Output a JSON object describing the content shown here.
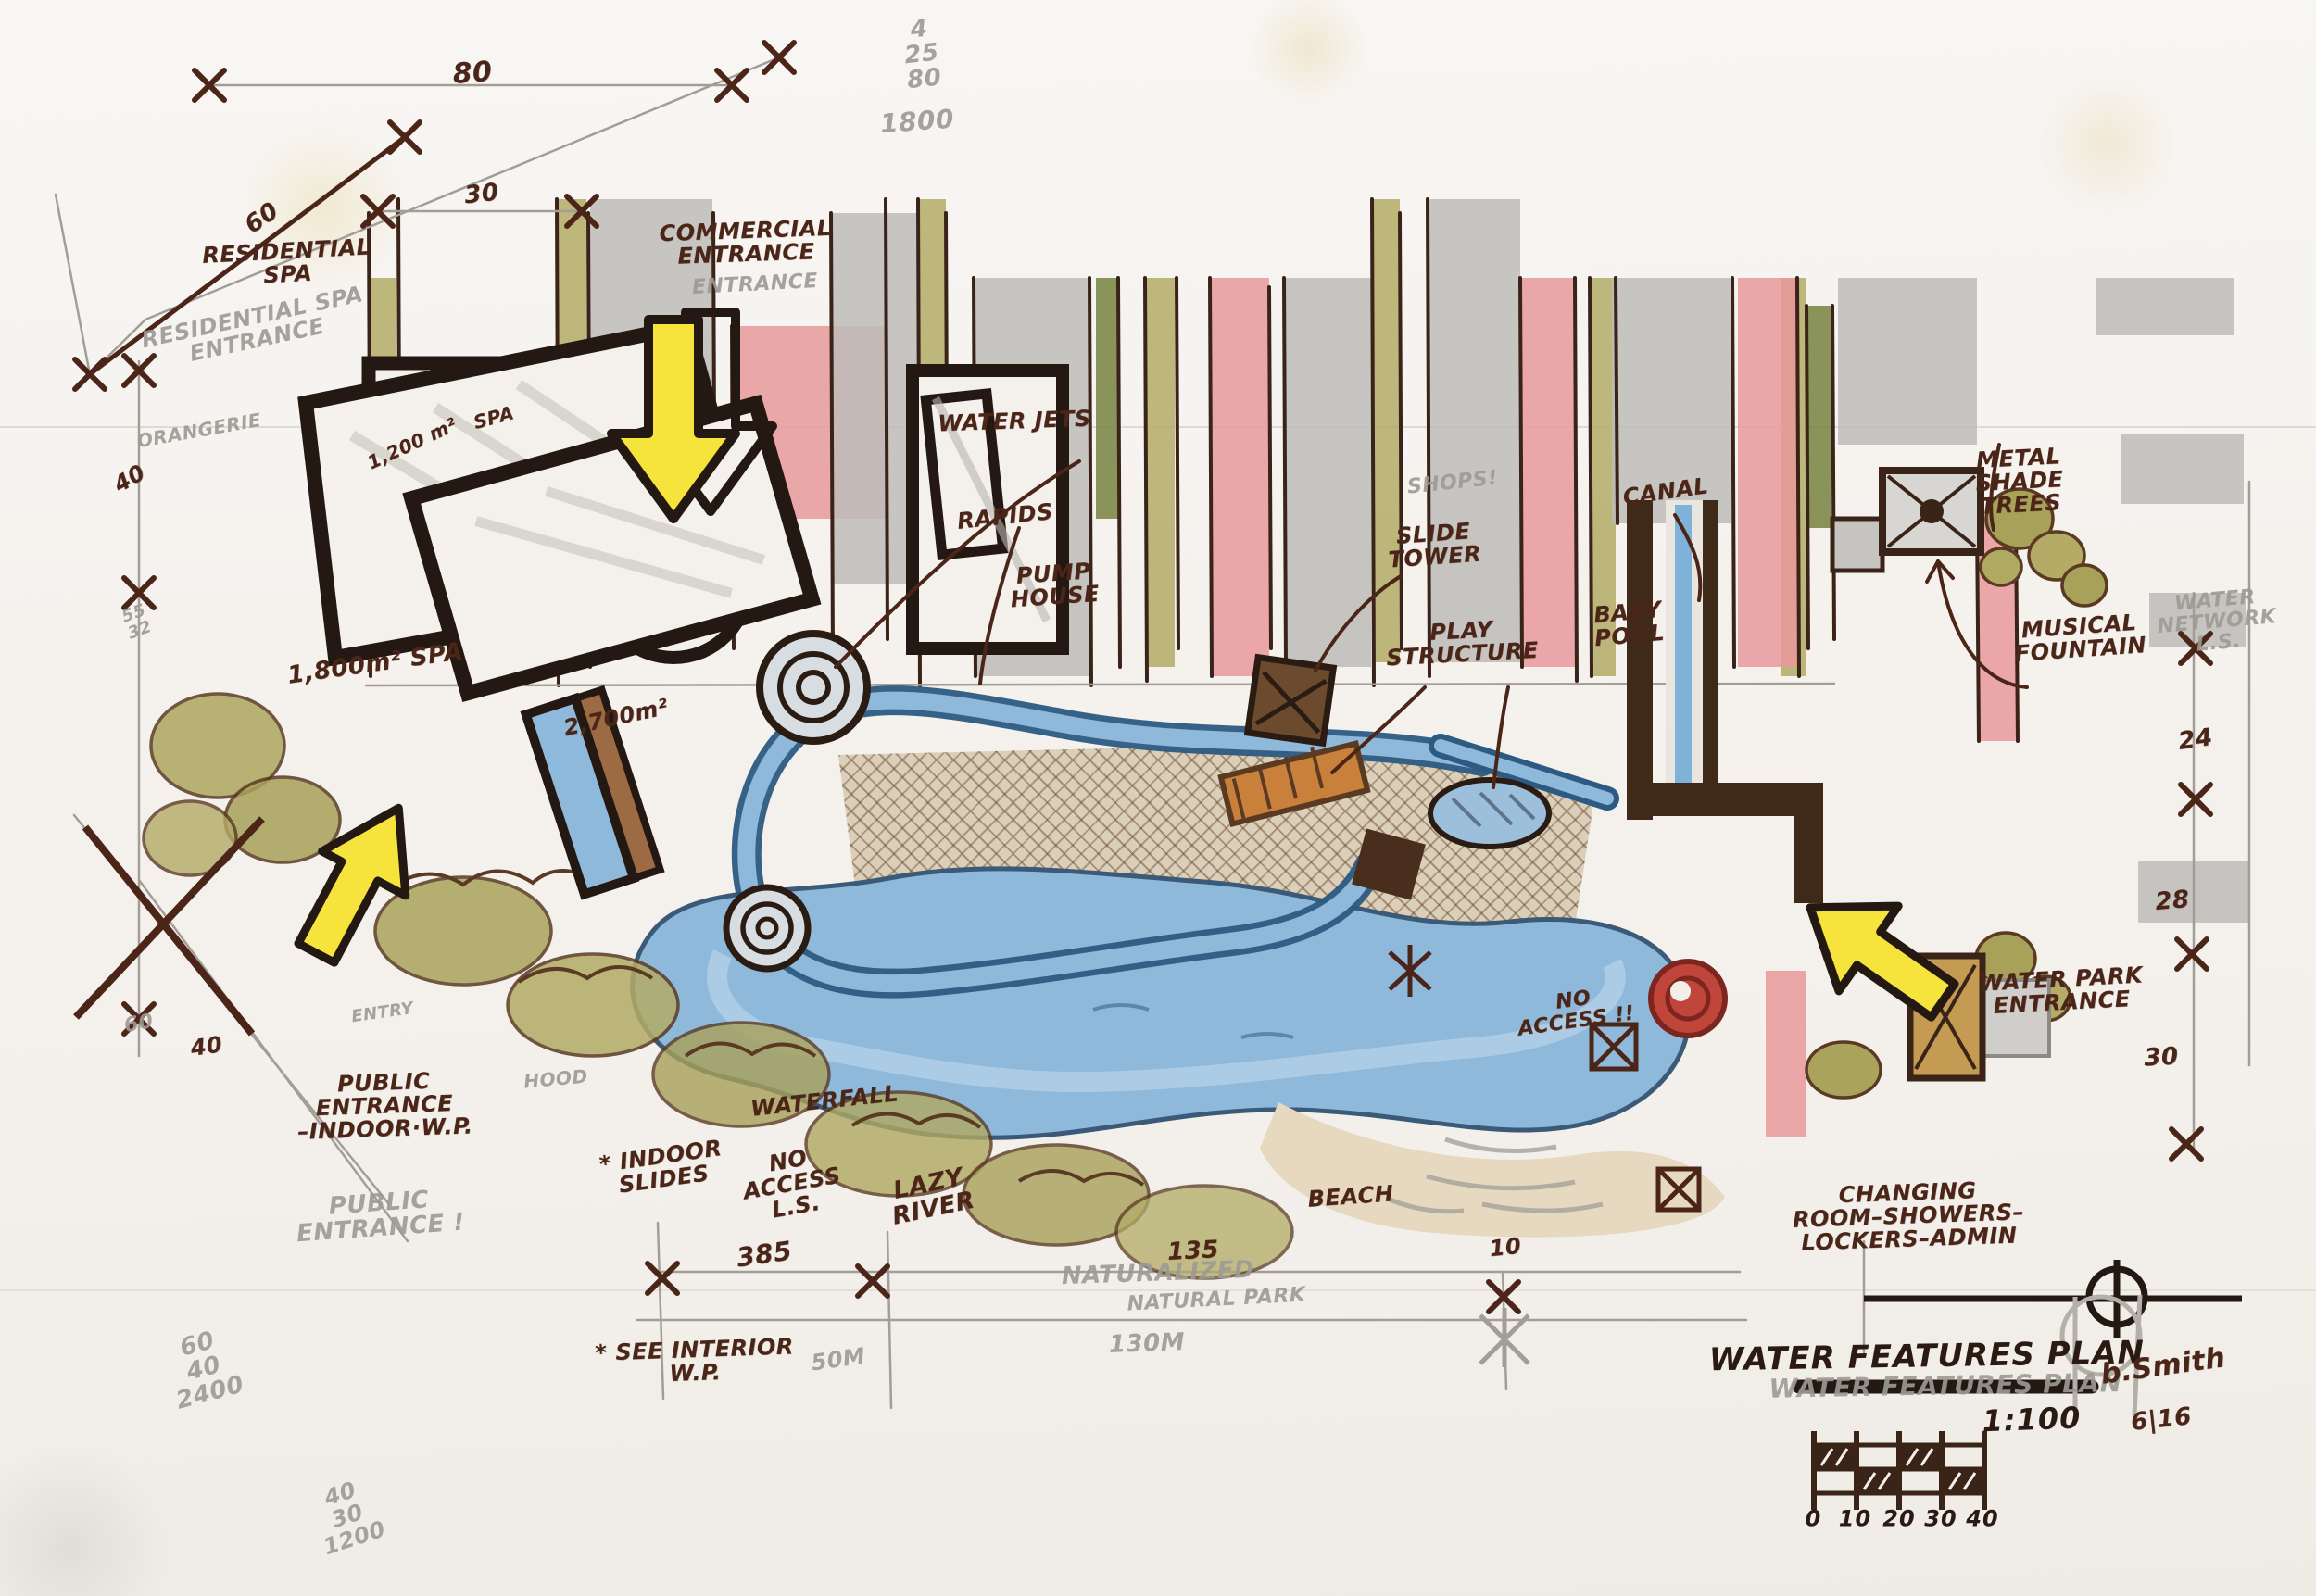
{
  "document": {
    "kind": "hand-drawn water park concept plan",
    "title": "WATER FEATURES PLAN",
    "scale": "1:100",
    "signature": "b.Smith",
    "date": "6|16",
    "scale_bar_labels": [
      "0",
      "10",
      "20",
      "30",
      "40"
    ]
  },
  "colors": {
    "paper": "#f6f3ef",
    "ink": "#4b2518",
    "pencil": "#9d9a94",
    "olive": "#b3ab66",
    "dark_green": "#77813f",
    "gray_marker": "#bdbcb9",
    "pink": "#e8999b",
    "water": "#8fb9da",
    "water_dark": "#2c5a82",
    "deck": "#dbcfb9",
    "arrow_yellow": "#f6e33c",
    "wall_dark": "#3f2a1a",
    "spiral_red": "#b03a32"
  },
  "annotations": [
    {
      "name": "dim-80",
      "style": "marker",
      "x": 20.4,
      "y": 4.6,
      "rot": -4,
      "fs": 30,
      "t": [
        "80"
      ]
    },
    {
      "name": "calc-25x80",
      "style": "pencil",
      "x": 39.8,
      "y": 3.4,
      "rot": -6,
      "fs": 26,
      "t": [
        "4",
        "25",
        "80"
      ]
    },
    {
      "name": "calc-25x80-total",
      "style": "pencil",
      "x": 39.6,
      "y": 7.6,
      "rot": -4,
      "fs": 28,
      "t": [
        "1800"
      ]
    },
    {
      "name": "dim-30-top",
      "style": "marker",
      "x": 20.8,
      "y": 12.2,
      "rot": -6,
      "fs": 26,
      "t": [
        "30"
      ]
    },
    {
      "name": "dim-60-diagonal",
      "style": "marker",
      "x": 11.3,
      "y": 13.7,
      "rot": -35,
      "fs": 26,
      "t": [
        "60"
      ]
    },
    {
      "name": "label-residential-spa",
      "style": "marker",
      "x": 12.4,
      "y": 16.5,
      "rot": -3,
      "fs": 24,
      "t": [
        "RESIDENTIAL",
        "SPA"
      ]
    },
    {
      "name": "ghost-residential-spa-entrance",
      "style": "pencil",
      "x": 11.0,
      "y": 20.6,
      "rot": -12,
      "fs": 24,
      "t": [
        "RESIDENTIAL SPA",
        "ENTRANCE"
      ]
    },
    {
      "name": "label-commercial-entrance",
      "style": "marker",
      "x": 32.2,
      "y": 15.2,
      "rot": -2,
      "fs": 24,
      "t": [
        "COMMERCIAL",
        "ENTRANCE"
      ]
    },
    {
      "name": "ghost-commercial-entrance",
      "style": "pencil",
      "x": 32.6,
      "y": 17.9,
      "rot": -3,
      "fs": 22,
      "t": [
        "ENTRANCE"
      ]
    },
    {
      "name": "ghost-orangerie",
      "style": "pencil",
      "x": 8.6,
      "y": 27.0,
      "rot": -10,
      "fs": 20,
      "t": [
        "ORANGERIE"
      ]
    },
    {
      "name": "dim-40-upper-left",
      "style": "marker",
      "x": 5.6,
      "y": 30.0,
      "rot": -30,
      "fs": 24,
      "t": [
        "40"
      ]
    },
    {
      "name": "note-55-32",
      "style": "pencil",
      "x": 5.9,
      "y": 39.0,
      "rot": -20,
      "fs": 18,
      "t": [
        "55",
        "32"
      ]
    },
    {
      "name": "label-spa-1200",
      "style": "marker",
      "x": 17.8,
      "y": 27.8,
      "rot": -25,
      "fs": 20,
      "t": [
        "1,200 m²"
      ]
    },
    {
      "name": "label-spa-upper",
      "style": "marker",
      "x": 21.3,
      "y": 26.2,
      "rot": -15,
      "fs": 20,
      "t": [
        "SPA"
      ]
    },
    {
      "name": "label-water-jets",
      "style": "marker",
      "x": 43.8,
      "y": 26.4,
      "rot": -2,
      "fs": 24,
      "t": [
        "WATER JETS"
      ]
    },
    {
      "name": "label-rapids",
      "style": "marker",
      "x": 43.4,
      "y": 32.4,
      "rot": -6,
      "fs": 24,
      "t": [
        "RAPIDS"
      ]
    },
    {
      "name": "label-pump-house",
      "style": "marker",
      "x": 45.5,
      "y": 36.7,
      "rot": -4,
      "fs": 24,
      "t": [
        "PUMP",
        "HOUSE"
      ]
    },
    {
      "name": "ghost-shops",
      "style": "pencil",
      "x": 62.7,
      "y": 30.3,
      "rot": -6,
      "fs": 22,
      "t": [
        "SHOPS!"
      ]
    },
    {
      "name": "label-slide-tower",
      "style": "marker",
      "x": 61.9,
      "y": 34.2,
      "rot": -4,
      "fs": 24,
      "t": [
        "SLIDE",
        "TOWER"
      ]
    },
    {
      "name": "label-play-structure",
      "style": "marker",
      "x": 63.1,
      "y": 40.3,
      "rot": -3,
      "fs": 24,
      "t": [
        "PLAY",
        "STRUCTURE"
      ]
    },
    {
      "name": "label-baby-pool",
      "style": "marker",
      "x": 70.3,
      "y": 39.1,
      "rot": -5,
      "fs": 24,
      "t": [
        "BABY",
        "POOL"
      ]
    },
    {
      "name": "label-canal",
      "style": "marker",
      "x": 71.9,
      "y": 30.8,
      "rot": -8,
      "fs": 24,
      "t": [
        "CANAL"
      ]
    },
    {
      "name": "label-metal-shade-trees",
      "style": "marker",
      "x": 87.2,
      "y": 30.2,
      "rot": -3,
      "fs": 24,
      "t": [
        "METAL",
        "SHADE",
        "TREES"
      ]
    },
    {
      "name": "label-musical-fountain",
      "style": "marker",
      "x": 89.8,
      "y": 40.0,
      "rot": -4,
      "fs": 24,
      "t": [
        "MUSICAL",
        "FOUNTAIN"
      ]
    },
    {
      "name": "ghost-water-network",
      "style": "pencil",
      "x": 95.7,
      "y": 39.0,
      "rot": -5,
      "fs": 22,
      "t": [
        "WATER",
        "NETWORK",
        "L.S."
      ]
    },
    {
      "name": "dim-24",
      "style": "marker",
      "x": 94.8,
      "y": 46.4,
      "rot": -8,
      "fs": 26,
      "t": [
        "24"
      ]
    },
    {
      "name": "dim-28",
      "style": "marker",
      "x": 93.8,
      "y": 56.5,
      "rot": -5,
      "fs": 26,
      "t": [
        "28"
      ]
    },
    {
      "name": "dim-30-right",
      "style": "marker",
      "x": 93.3,
      "y": 66.3,
      "rot": -3,
      "fs": 26,
      "t": [
        "30"
      ]
    },
    {
      "name": "label-spa-1800",
      "style": "marker",
      "x": 16.2,
      "y": 41.6,
      "rot": -8,
      "fs": 26,
      "t": [
        "1,800m²   SPA"
      ]
    },
    {
      "name": "label-spa-2700",
      "style": "marker",
      "x": 26.6,
      "y": 45.0,
      "rot": -12,
      "fs": 24,
      "t": [
        "2,700m²"
      ]
    },
    {
      "name": "label-public-entrance",
      "style": "marker",
      "x": 16.6,
      "y": 69.3,
      "rot": -2,
      "fs": 24,
      "t": [
        "PUBLIC",
        "ENTRANCE",
        "–INDOOR·W.P."
      ]
    },
    {
      "name": "ghost-public-entrance",
      "style": "pencil",
      "x": 16.4,
      "y": 76.2,
      "rot": -4,
      "fs": 26,
      "t": [
        "PUBLIC",
        "ENTRANCE !"
      ]
    },
    {
      "name": "ghost-entry",
      "style": "pencil",
      "x": 16.5,
      "y": 63.5,
      "rot": -8,
      "fs": 18,
      "t": [
        "ENTRY"
      ]
    },
    {
      "name": "ghost-hood",
      "style": "pencil",
      "x": 24.0,
      "y": 67.6,
      "rot": -5,
      "fs": 20,
      "t": [
        "HOOD"
      ]
    },
    {
      "name": "label-waterfall",
      "style": "marker",
      "x": 35.6,
      "y": 69.0,
      "rot": -6,
      "fs": 24,
      "t": [
        "WATERFALL"
      ]
    },
    {
      "name": "label-indoor-slides",
      "style": "marker",
      "x": 28.6,
      "y": 73.2,
      "rot": -8,
      "fs": 24,
      "t": [
        "* INDOOR",
        "SLIDES"
      ]
    },
    {
      "name": "label-no-access-ls",
      "style": "marker",
      "x": 34.2,
      "y": 74.2,
      "rot": -10,
      "fs": 24,
      "t": [
        "NO",
        "ACCESS",
        "L.S."
      ]
    },
    {
      "name": "label-lazy-river",
      "style": "marker",
      "x": 40.2,
      "y": 75.0,
      "rot": -12,
      "fs": 26,
      "t": [
        "LAZY",
        "RIVER"
      ]
    },
    {
      "name": "dim-385",
      "style": "marker",
      "x": 33.0,
      "y": 78.6,
      "rot": -8,
      "fs": 28,
      "t": [
        "385"
      ]
    },
    {
      "name": "label-see-interior-wp",
      "style": "marker",
      "x": 30.0,
      "y": 85.3,
      "rot": -2,
      "fs": 24,
      "t": [
        "* SEE INTERIOR",
        "W.P."
      ]
    },
    {
      "name": "ghost-50m",
      "style": "pencil",
      "x": 36.2,
      "y": 85.2,
      "rot": -8,
      "fs": 24,
      "t": [
        "50M"
      ]
    },
    {
      "name": "calc-60x40",
      "style": "pencil",
      "x": 8.8,
      "y": 85.8,
      "rot": -15,
      "fs": 26,
      "t": [
        "60",
        "40",
        "2400"
      ]
    },
    {
      "name": "calc-40x30",
      "style": "pencil",
      "x": 15.0,
      "y": 95.0,
      "rot": -18,
      "fs": 24,
      "t": [
        "40",
        "30",
        "1200"
      ]
    },
    {
      "name": "dim-60-lower-left",
      "style": "pencil",
      "x": 6.0,
      "y": 64.2,
      "rot": -10,
      "fs": 22,
      "t": [
        "60"
      ]
    },
    {
      "name": "dim-40-lower-left",
      "style": "marker",
      "x": 8.9,
      "y": 65.6,
      "rot": -8,
      "fs": 24,
      "t": [
        "40"
      ]
    },
    {
      "name": "ghost-naturalized",
      "style": "pencil",
      "x": 50.0,
      "y": 79.8,
      "rot": -2,
      "fs": 26,
      "t": [
        "NATURALIZED"
      ]
    },
    {
      "name": "ghost-natural-park",
      "style": "pencil",
      "x": 52.5,
      "y": 81.5,
      "rot": -3,
      "fs": 22,
      "t": [
        "NATURAL PARK"
      ]
    },
    {
      "name": "ghost-130m",
      "style": "pencil",
      "x": 49.5,
      "y": 84.2,
      "rot": -2,
      "fs": 26,
      "t": [
        "130M"
      ]
    },
    {
      "name": "dim-135",
      "style": "marker",
      "x": 51.5,
      "y": 78.4,
      "rot": -3,
      "fs": 26,
      "t": [
        "135"
      ]
    },
    {
      "name": "label-beach",
      "style": "marker",
      "x": 58.3,
      "y": 75.0,
      "rot": -4,
      "fs": 24,
      "t": [
        "BEACH"
      ]
    },
    {
      "name": "dim-10",
      "style": "marker",
      "x": 65.0,
      "y": 78.2,
      "rot": -6,
      "fs": 24,
      "t": [
        "10"
      ]
    },
    {
      "name": "label-no-access-lagoon",
      "style": "marker",
      "x": 68.0,
      "y": 63.4,
      "rot": -8,
      "fs": 22,
      "t": [
        "NO",
        "ACCESS !!"
      ]
    },
    {
      "name": "label-changing-rooms",
      "style": "marker",
      "x": 82.4,
      "y": 76.2,
      "rot": -2,
      "fs": 24,
      "t": [
        "CHANGING",
        "ROOM–SHOWERS–",
        "LOCKERS–ADMIN"
      ]
    },
    {
      "name": "label-water-park-entrance",
      "style": "marker",
      "x": 89.0,
      "y": 62.1,
      "rot": -3,
      "fs": 24,
      "t": [
        "WATER PARK",
        "ENTRANCE"
      ]
    },
    {
      "name": "ghost-title",
      "style": "pencil",
      "x": 84.0,
      "y": 86.8,
      "rot": -1,
      "fs": 28,
      "t": [
        "WATER FEATURES PLAN"
      ]
    },
    {
      "name": "plan-title",
      "style": "title",
      "x": 83.2,
      "y": 85.0,
      "rot": -1,
      "fs": 34,
      "t": [
        "WATER FEATURES PLAN"
      ]
    },
    {
      "name": "plan-scale",
      "style": "title",
      "x": 87.7,
      "y": 89.0,
      "rot": -2,
      "fs": 32,
      "t": [
        "1:100"
      ]
    },
    {
      "name": "plan-signature",
      "style": "marker",
      "x": 93.4,
      "y": 85.6,
      "rot": -8,
      "fs": 30,
      "t": [
        "b.Smith"
      ]
    },
    {
      "name": "plan-date",
      "style": "marker",
      "x": 93.3,
      "y": 89.0,
      "rot": -6,
      "fs": 26,
      "t": [
        "6|16"
      ]
    },
    {
      "name": "scalebar-0",
      "style": "title",
      "x": 78.3,
      "y": 95.2,
      "rot": 0,
      "fs": 24,
      "t": [
        "0"
      ]
    },
    {
      "name": "scalebar-10",
      "style": "title",
      "x": 80.1,
      "y": 95.2,
      "rot": 0,
      "fs": 24,
      "t": [
        "10"
      ]
    },
    {
      "name": "scalebar-20",
      "style": "title",
      "x": 82.0,
      "y": 95.2,
      "rot": 0,
      "fs": 24,
      "t": [
        "20"
      ]
    },
    {
      "name": "scalebar-30",
      "style": "title",
      "x": 83.8,
      "y": 95.2,
      "rot": 0,
      "fs": 24,
      "t": [
        "30"
      ]
    },
    {
      "name": "scalebar-40",
      "style": "title",
      "x": 85.6,
      "y": 95.2,
      "rot": 0,
      "fs": 24,
      "t": [
        "40"
      ]
    }
  ]
}
